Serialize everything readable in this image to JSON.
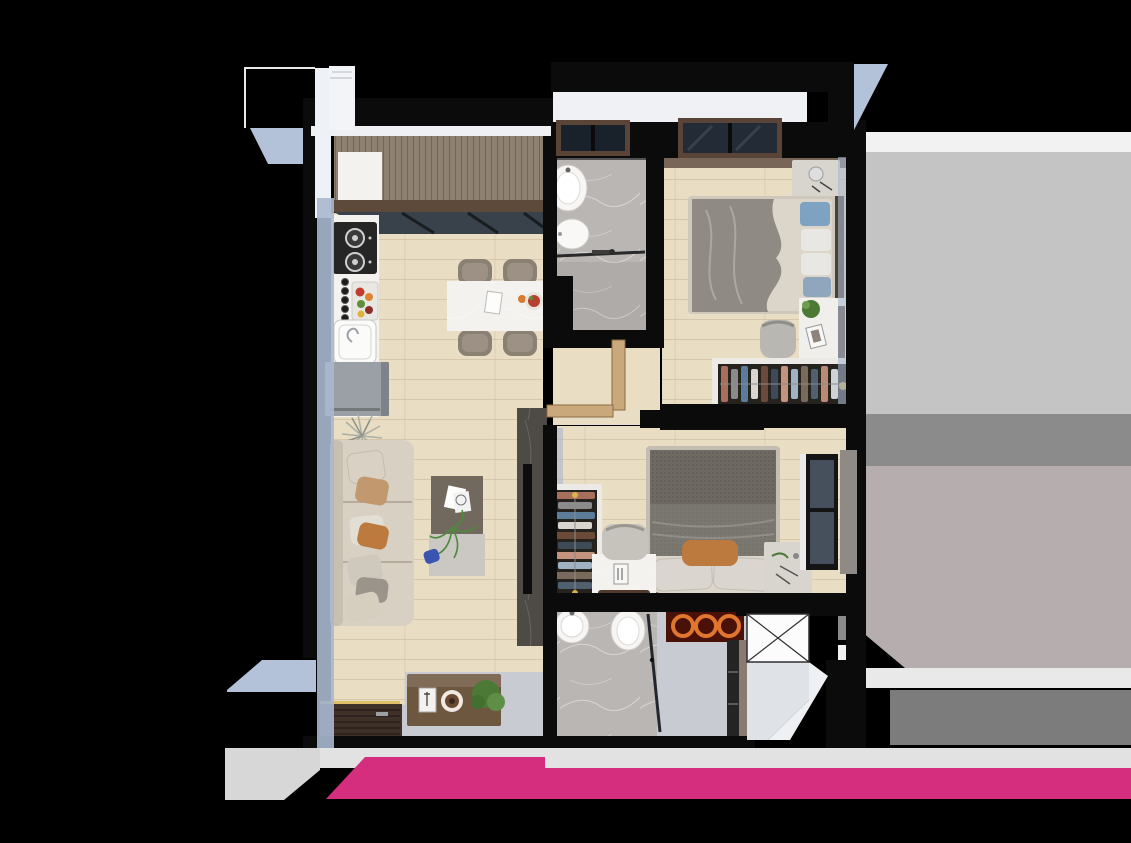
{
  "canvas": {
    "width": 1131,
    "height": 843
  },
  "scene": {
    "kind": "apartment-floor-plan-3d-render",
    "unit": "2-bedroom-2-bath"
  },
  "palette": {
    "background": "#000000",
    "wall": "#0b0b0b",
    "wall_white": "#f0f1f4",
    "wall_face": "#a9b8d0",
    "wall_face_blue": "#b3c2d8",
    "wood": "#e9ddc3",
    "bath_floor": "#b9b6b3",
    "entry_floor": "#c8cbd1",
    "deck": "#8e8172",
    "beam": "#5d4a3b",
    "glass": "#39414b",
    "counter_white": "#f3f2ef",
    "appliance_dark": "#262626",
    "fridge": "#9aa0a5",
    "chair_taupe": "#8a8174",
    "sofa": "#d8d1c3",
    "pillow_tan": "#c2996f",
    "pillow_orange": "#bd7a3e",
    "pillow_blue": "#7ea3c2",
    "pillow_white": "#e9e7e3",
    "table_glass": "#6a6257",
    "table_light": "#cbc7c2",
    "tv_wall": "#4e4a46",
    "tv_black": "#0d0d0d",
    "mattress": "#dcd5ca",
    "blanket": "#8f8a84",
    "blanket_dark": "#6e6a63",
    "blanket_mid": "#7b7771",
    "headboard": "#4a4035",
    "headboard_brown": "#5a4032",
    "wardrobe_frame": "#eceae6",
    "wardrobe_interior": "#26221d",
    "nightstand": "#d8d4ce",
    "desk_white": "#f0efec",
    "cabinet_brown": "#6e573f",
    "cabinet_dark": "#242424",
    "door_wood": "#c9a87b",
    "door_brown": "#8a7a72",
    "mat": "#3f3028",
    "threshold": "#c0a5a0",
    "ring_orange": "#e0762e",
    "ring_bg": "#4a1108",
    "shaft_white": "#fcfcfc",
    "window_frame": "#5a4438",
    "window_glass": "#232b36",
    "curtain": "#8f8a86",
    "plant_green": "#4c7a36",
    "plant_silver": "#aab0a4",
    "accent_yellow": "#d9b44a",
    "neighbor_white": "#f2f2f2",
    "neighbor_light": "#c4c4c4",
    "neighbor_mid": "#8b8b8b",
    "neighbor_warm": "#b6aeae",
    "neighbor_band": "#e9e9e9",
    "neighbor_dark": "#7c7c7c",
    "band_gray": "#e2e2e2",
    "band_gray2": "#d7d7d7",
    "brand_pink": "#d62e7e",
    "blue_object": "#3a55b0",
    "food_red": "#b5402f"
  },
  "wardrobe": {
    "clothes_colors": [
      "#a8705c",
      "#8b8b8b",
      "#5c7d99",
      "#d9d5cf",
      "#6b4a3a",
      "#3f4a58",
      "#c4937e",
      "#9fb3c4",
      "#7a6a5c",
      "#50606f",
      "#b98a74",
      "#cfd3d6",
      "#5a4a3f"
    ]
  },
  "rooms": [
    {
      "id": "balcony",
      "features": [
        "wood-deck",
        "white-cabinet",
        "glass-sliding-door",
        "beam"
      ]
    },
    {
      "id": "kitchen",
      "features": [
        "cooktop",
        "sink",
        "refrigerator",
        "counter",
        "spice-jars",
        "fruit-tray"
      ]
    },
    {
      "id": "dining",
      "features": [
        "island-table",
        "chairs",
        "tableware"
      ]
    },
    {
      "id": "bathroom-1",
      "features": [
        "basin",
        "toilet",
        "shower-glass",
        "towel-rack",
        "window"
      ]
    },
    {
      "id": "bedroom-1",
      "features": [
        "double-bed",
        "nightstand",
        "desk",
        "chair",
        "open-wardrobe",
        "window"
      ]
    },
    {
      "id": "hallway",
      "features": [
        "open-door-leaves"
      ]
    },
    {
      "id": "living-room",
      "features": [
        "sofa",
        "coffee-table",
        "tv-wall",
        "tv",
        "floor-plant",
        "sideboard"
      ]
    },
    {
      "id": "bedroom-2",
      "features": [
        "double-bed",
        "open-wardrobe",
        "desk",
        "chair",
        "nightstand",
        "tv",
        "window",
        "curtain"
      ]
    },
    {
      "id": "bathroom-2",
      "features": [
        "basin",
        "tub",
        "shower-glass",
        "towel-shelf",
        "tall-cabinet",
        "door"
      ]
    },
    {
      "id": "entrance",
      "features": [
        "door-mat",
        "threshold",
        "yellow-trim"
      ]
    },
    {
      "id": "service-shaft",
      "features": [
        "cross-marker"
      ]
    }
  ],
  "branding": {
    "bar_colors": [
      "#e2e2e2",
      "#d62e7e"
    ],
    "style": "cropped-logo-bar"
  }
}
